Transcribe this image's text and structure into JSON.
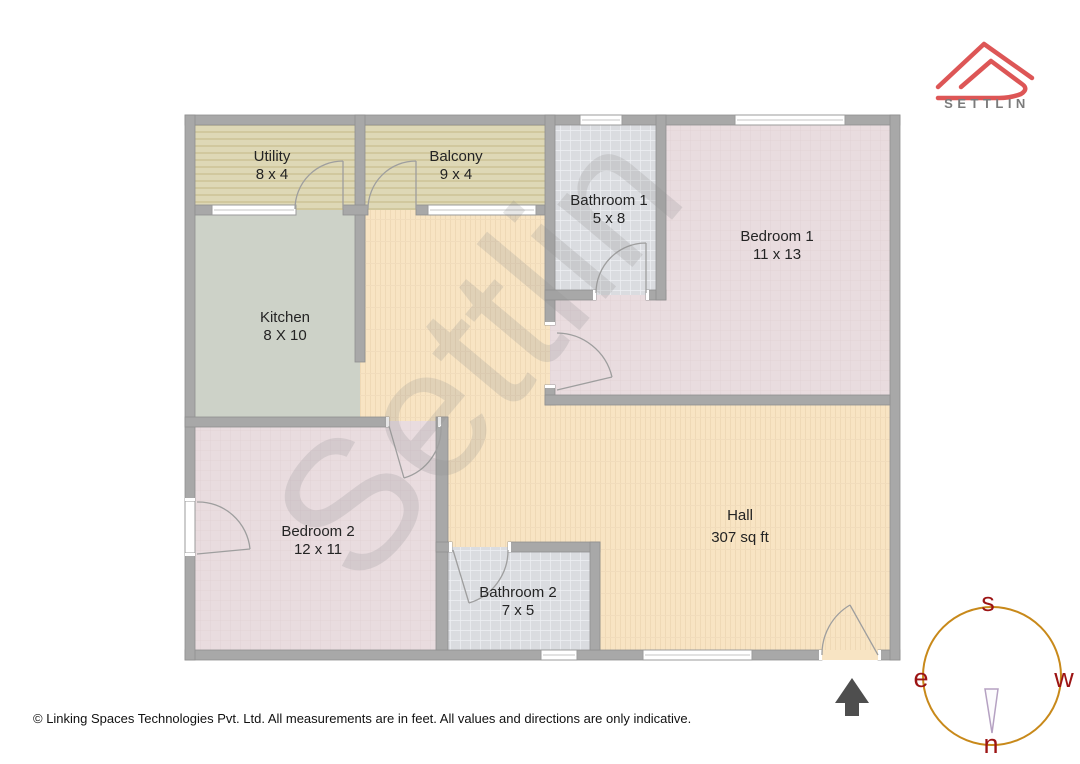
{
  "header": {
    "brand_name": "SETTLIN"
  },
  "watermark_text": "Settlin",
  "rooms": {
    "utility": {
      "name": "Utility",
      "dims": "8 x 4"
    },
    "balcony": {
      "name": "Balcony",
      "dims": "9 x 4"
    },
    "bathroom1": {
      "name": "Bathroom 1",
      "dims": "5 x 8"
    },
    "bedroom1": {
      "name": "Bedroom 1",
      "dims": "11 x 13"
    },
    "kitchen": {
      "name": "Kitchen",
      "dims": "8 X 10"
    },
    "bedroom2": {
      "name": "Bedroom 2",
      "dims": "12 x 11"
    },
    "bathroom2": {
      "name": "Bathroom 2",
      "dims": "7 x 5"
    },
    "hall": {
      "name": "Hall",
      "dims": "307 sq ft"
    }
  },
  "compass": {
    "top": "s",
    "left": "e",
    "right": "w",
    "bottom": "n"
  },
  "footer": {
    "copyright": "© Linking Spaces Technologies Pvt. Ltd. All measurements are in feet. All values and directions are only indicative."
  },
  "colors": {
    "wall": "#a8a8a8",
    "utility_balcony_floor": "#ded8b6",
    "kitchen_floor": "#cdd2c8",
    "bathroom_floor": "#dadce0",
    "bedroom_floor": "#e9dcdf",
    "hall_floor": "#f8e4c3",
    "logo_red": "#dd5656",
    "compass_ring": "#c8891a",
    "compass_letters": "#9c1414",
    "entrance_arrow": "#4e4e4e"
  }
}
